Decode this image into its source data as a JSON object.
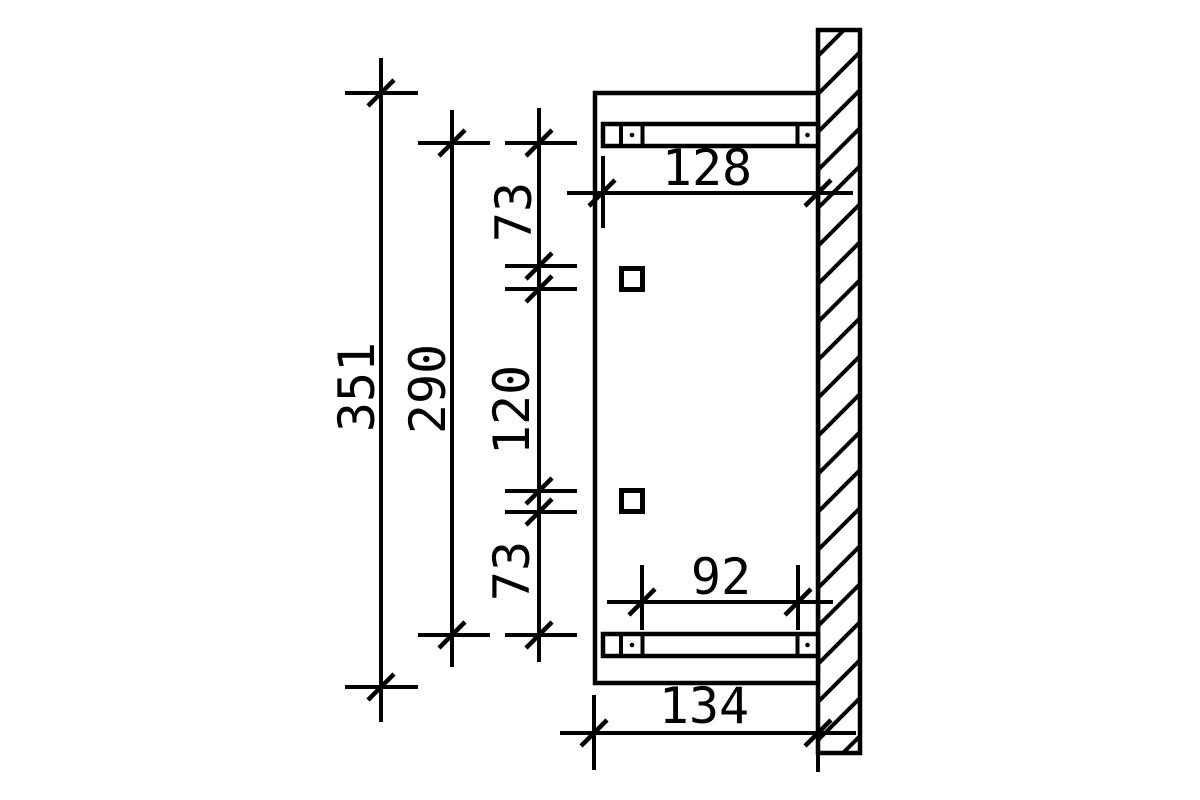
{
  "drawing": {
    "background_color": "#ffffff",
    "line_color": "#000000",
    "labels": {
      "overall_height": "351",
      "frame_height": "290",
      "top_offset": "73",
      "bracket_spacing": "120",
      "bottom_offset": "73",
      "top_rail_length": "128",
      "rail_bolt_spacing": "92",
      "bottom_depth": "134"
    }
  }
}
